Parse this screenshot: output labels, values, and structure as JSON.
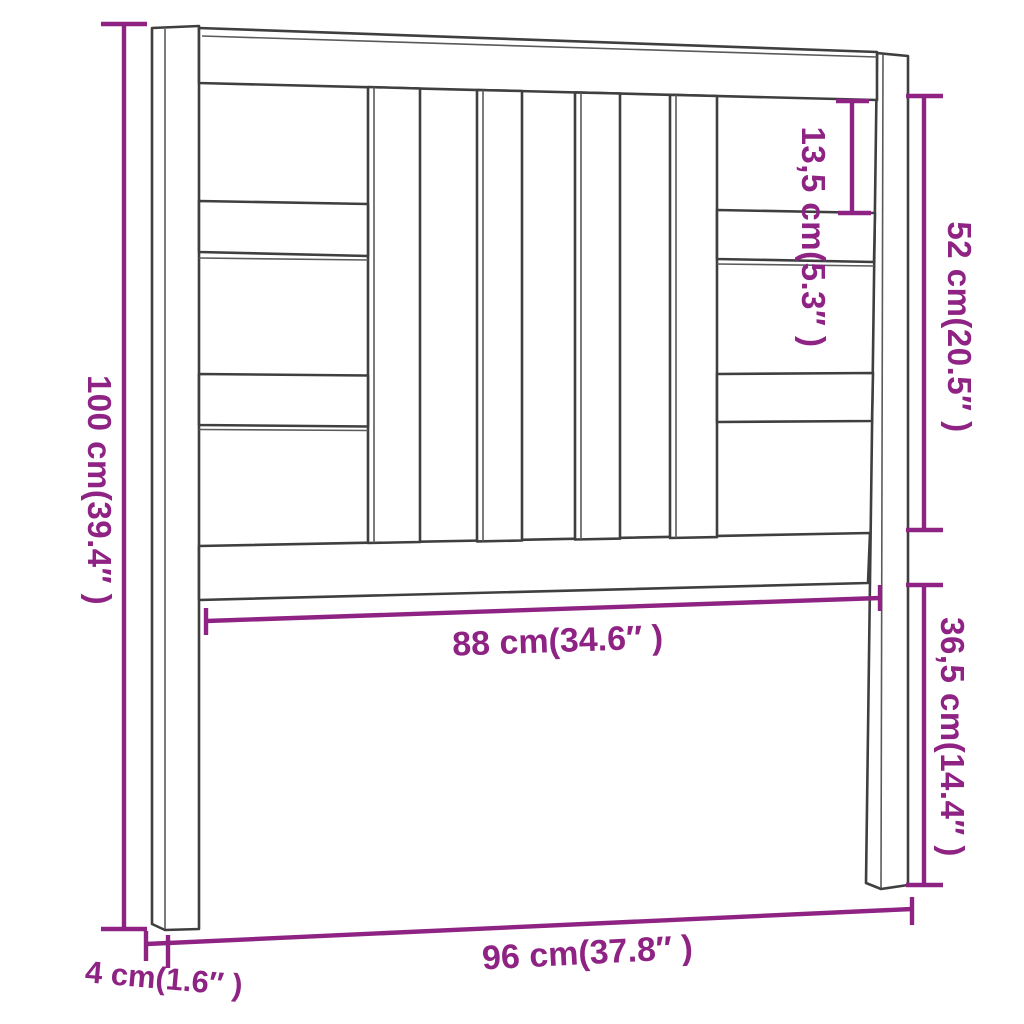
{
  "diagram": {
    "subject": "bed headboard dimension drawing",
    "colors": {
      "outline": "#3f3f3f",
      "dimension_accent": "#8e2383",
      "background": "#ffffff"
    },
    "dimensions": {
      "total_height": {
        "label": "100 cm(39.4″ )",
        "value_cm": "100",
        "value_inch": "39.4"
      },
      "top_gap": {
        "label": "13,5 cm(5.3″ )",
        "value_cm": "13,5",
        "value_inch": "5.3"
      },
      "panel_height": {
        "label": "52 cm(20.5″ )",
        "value_cm": "52",
        "value_inch": "20.5"
      },
      "lower_height": {
        "label": "36,5 cm(14.4″ )",
        "value_cm": "36,5",
        "value_inch": "14.4"
      },
      "inner_width": {
        "label": "88 cm(34.6″ )",
        "value_cm": "88",
        "value_inch": "34.6"
      },
      "total_width": {
        "label": "96 cm(37.8″ )",
        "value_cm": "96",
        "value_inch": "37.8"
      },
      "post_thickness": {
        "label": "4 cm(1.6″ )",
        "value_cm": "4",
        "value_inch": "1.6"
      }
    }
  }
}
